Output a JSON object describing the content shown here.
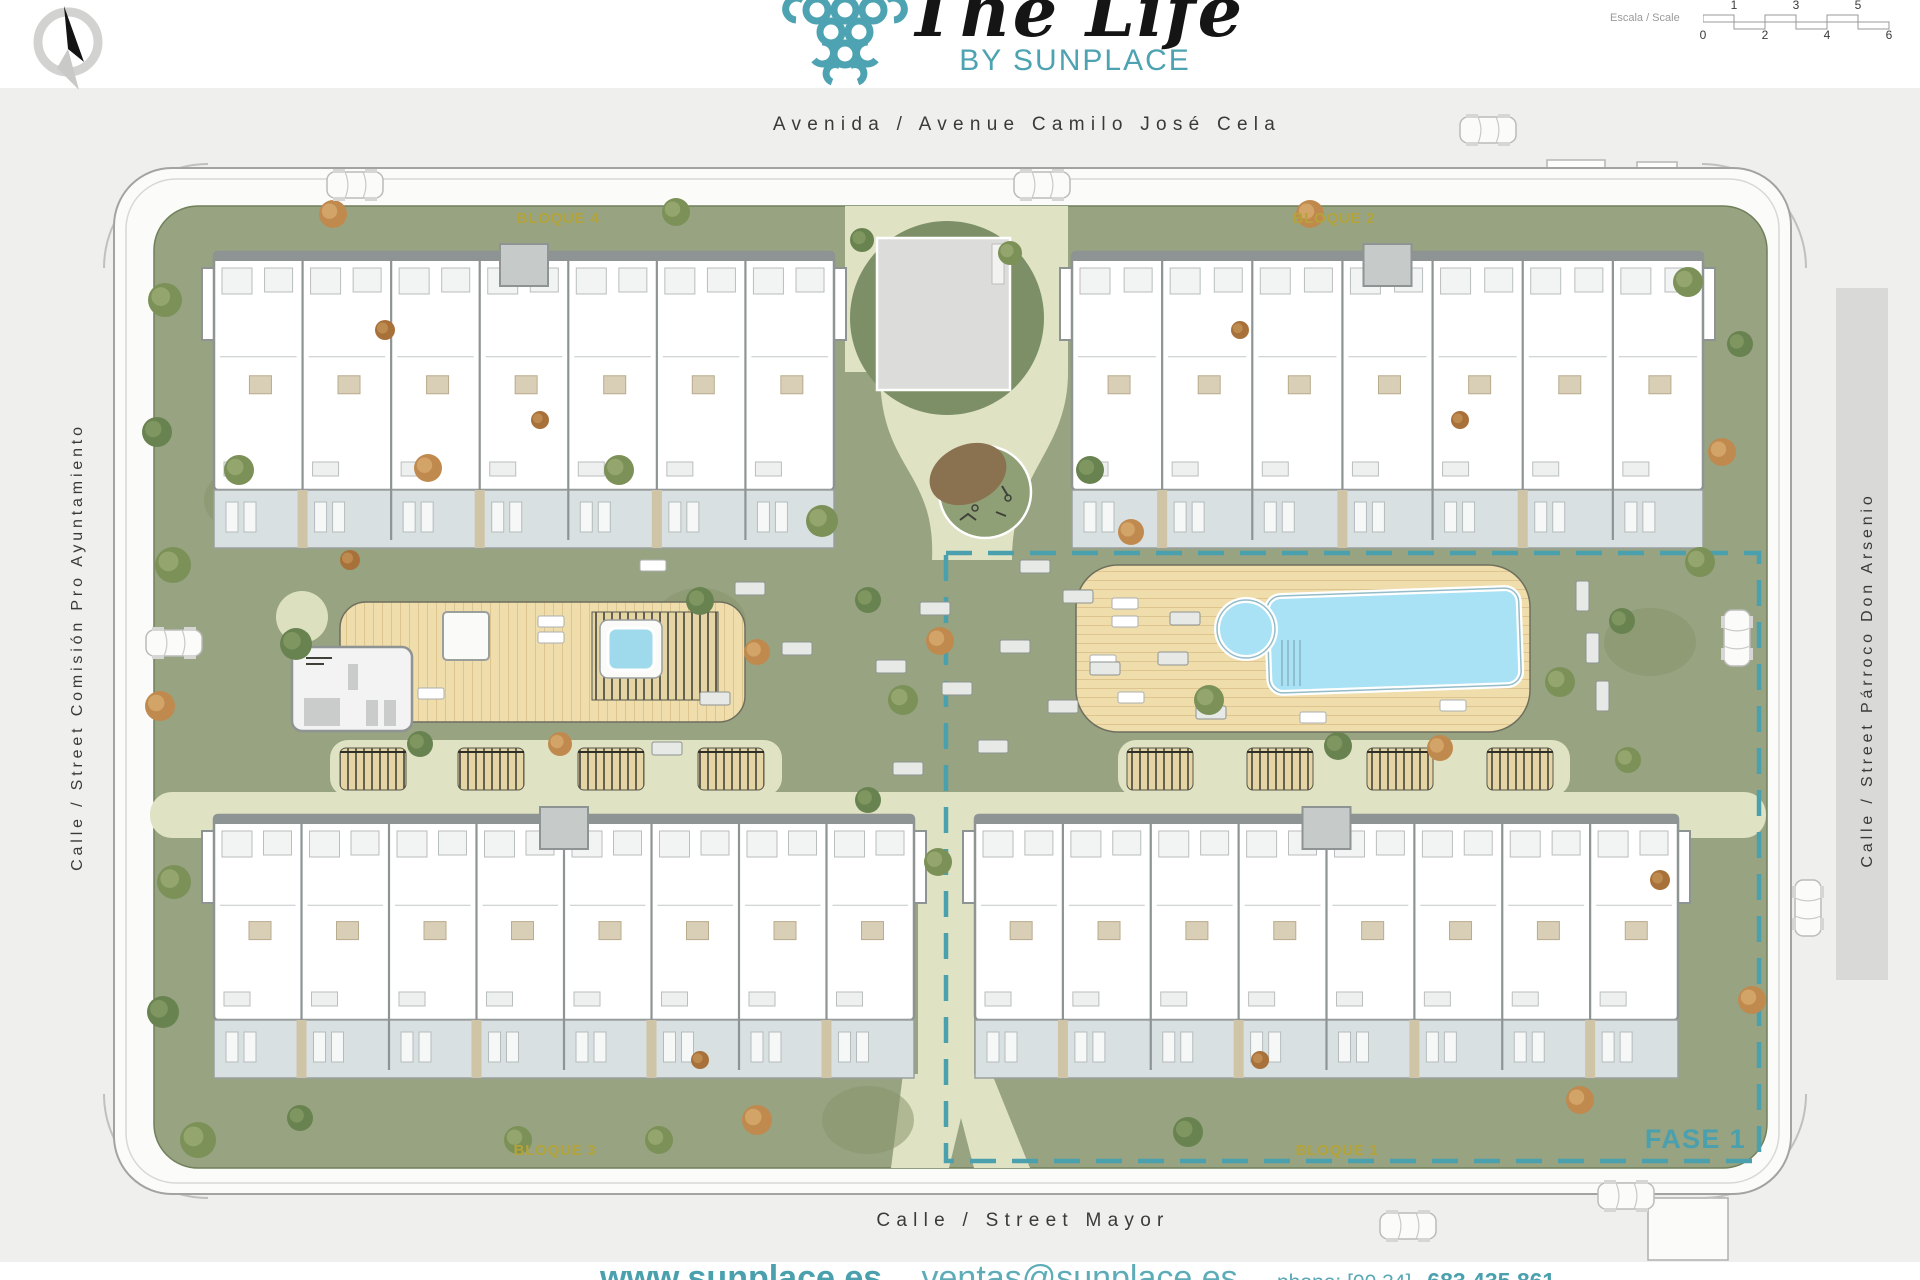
{
  "header": {
    "logo": {
      "title": "The Life",
      "subtitle": "BY SUNPLACE"
    },
    "scale": {
      "label": "Escala / Scale",
      "top_ticks": [
        "1",
        "3",
        "5"
      ],
      "bottom_ticks": [
        "0",
        "2",
        "4",
        "6"
      ]
    }
  },
  "streets": {
    "top": "Avenida / Avenue Camilo José Cela",
    "left": "Calle / Street Comisión Pro Ayuntamiento",
    "right": "Calle / Street Párroco Don Arsenio",
    "bottom": "Calle / Street Mayor"
  },
  "blocks": {
    "b1": "BLOQUE 1",
    "b2": "BLOQUE 2",
    "b3": "BLOQUE 3",
    "b4": "BLOQUE 4"
  },
  "phase": {
    "label": "FASE 1"
  },
  "footer": {
    "website": "www.sunplace.es",
    "sep": "-",
    "email": "ventas@sunplace.es",
    "phone_label": "phone: [00 34]",
    "phone_number": "683 435 861"
  },
  "colors": {
    "teal": "#4BA0AE",
    "logo_teal": "#4DA3B1",
    "block_label_olive": "#B3A339",
    "lawn_green": "#97A381",
    "path_cream": "#DFE2C3",
    "deck_tan": "#EFDDAC",
    "pool_blue": "#A9E2F4",
    "street_text": "#3A3A3A",
    "plan_background": "#EFEFED"
  }
}
